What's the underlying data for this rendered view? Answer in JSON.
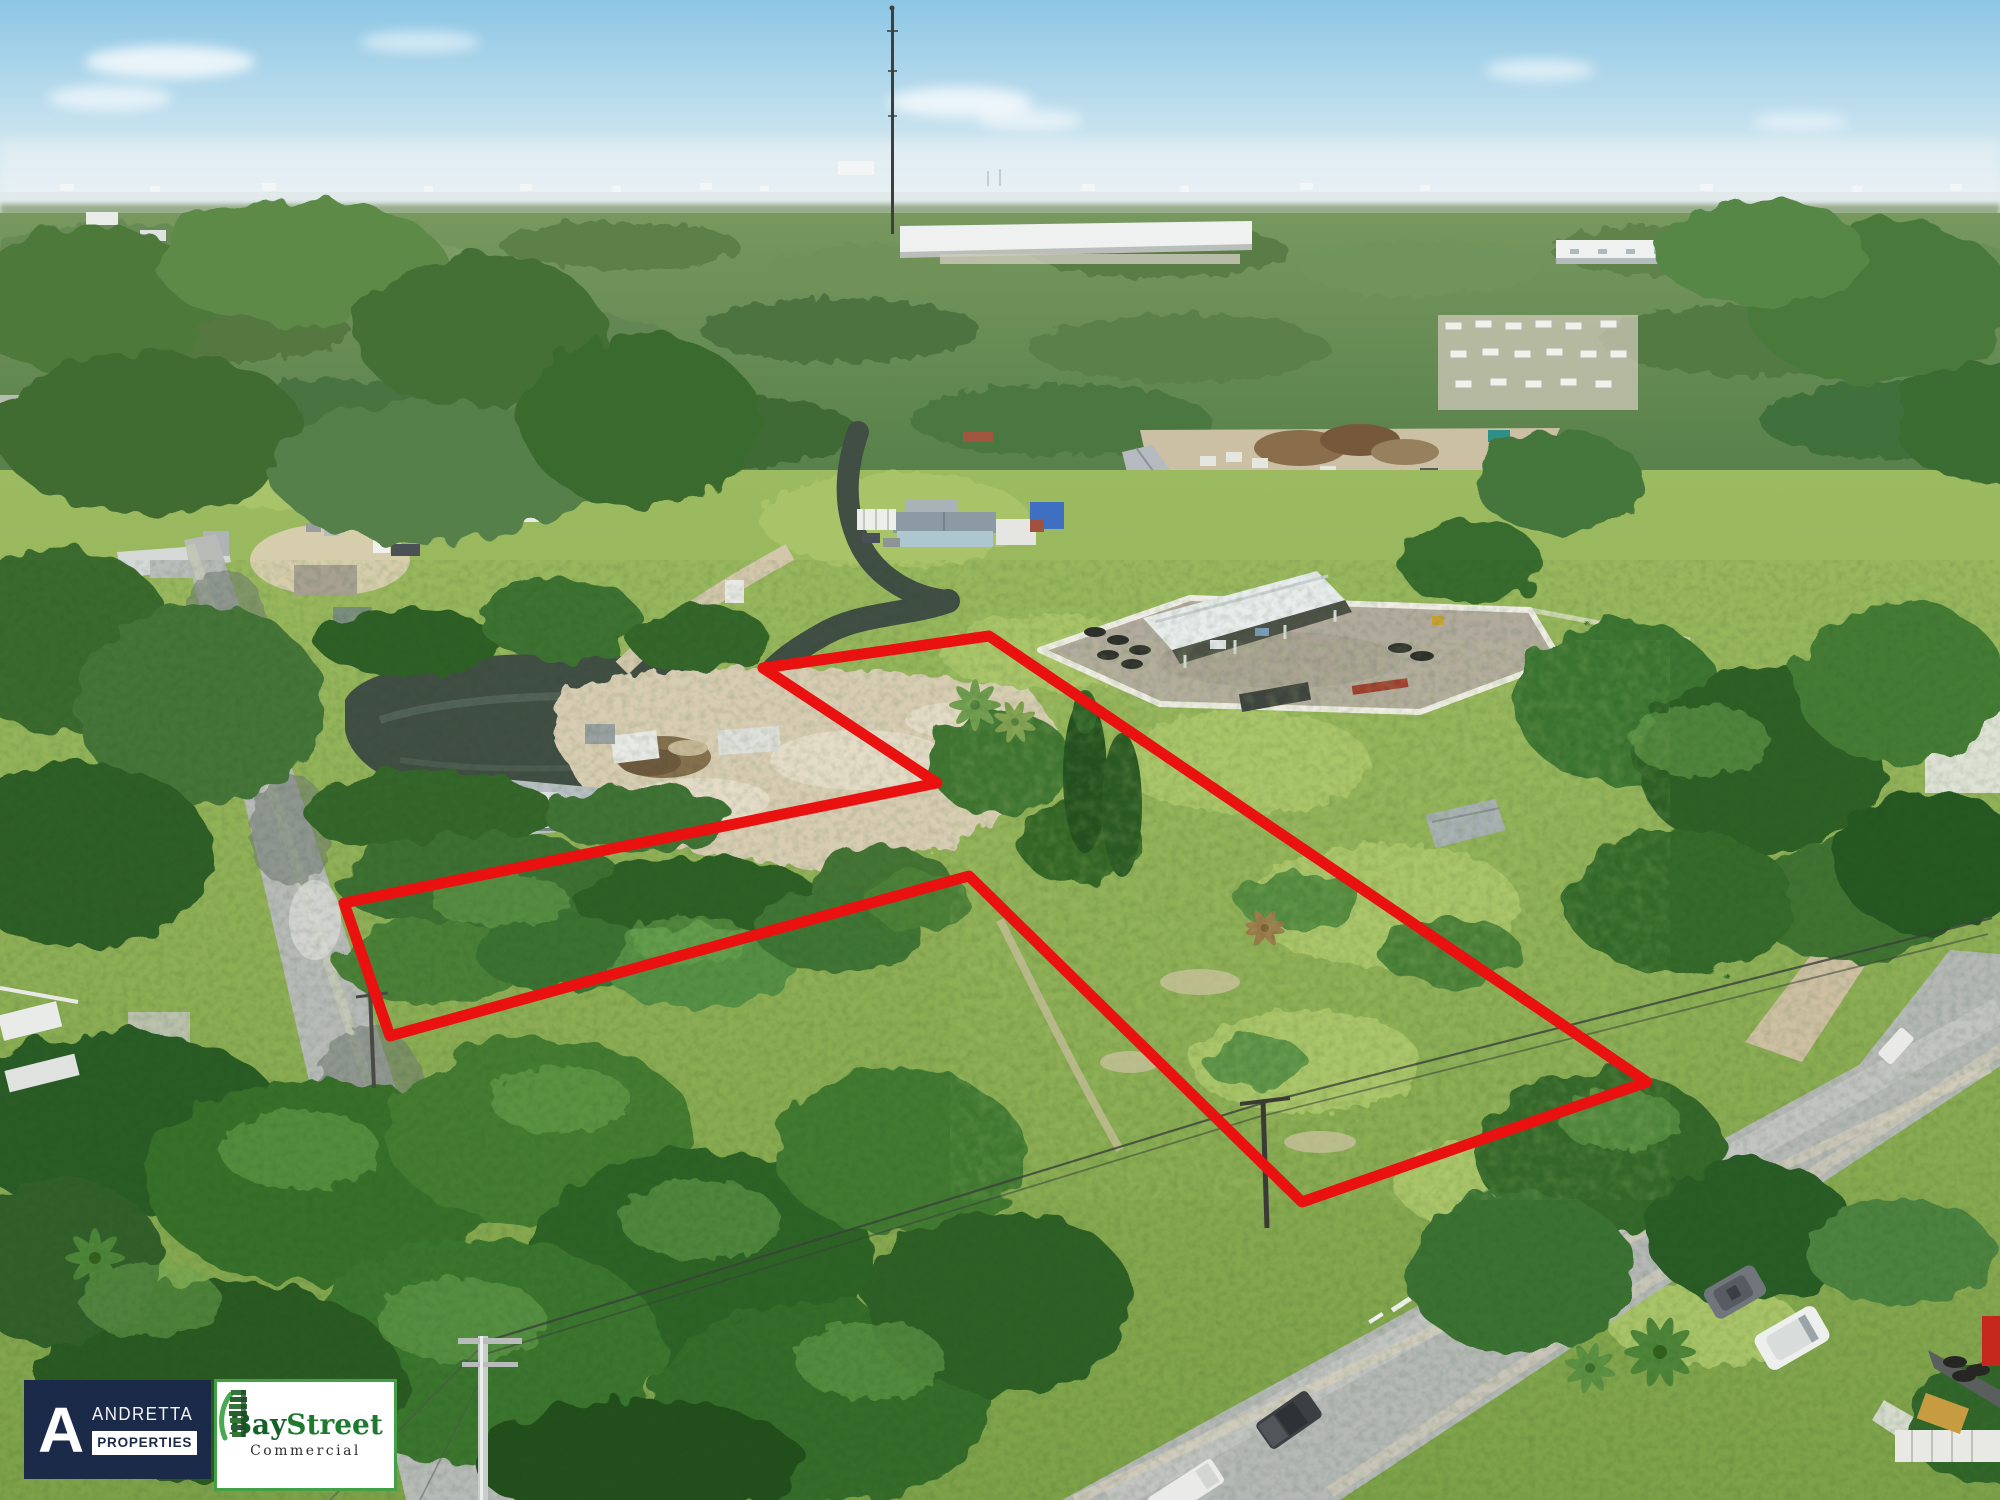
{
  "image": {
    "kind": "aerial-drone-real-estate-photo",
    "subject": "Vacant wooded land parcels outlined in red beside residential streets and an industrial yard"
  },
  "boundary": {
    "color": "#ea1111",
    "stroke_width": 11,
    "points": "989,636 1647,1082 1302,1202 969,876 390,1036 344,903 937,783 763,668"
  },
  "badges": {
    "andretta": {
      "initial": "A",
      "name": "ANDRETTA",
      "sub": "PROPERTIES",
      "bg_color": "#1b2a49",
      "text_color": "#ffffff"
    },
    "baystreet": {
      "brand_a": "Bay",
      "brand_b": "Street",
      "sub": "Commercial",
      "border_color": "#43a047",
      "green_dark": "#156028",
      "green": "#1e7a30",
      "sub_color": "#2f2f2f"
    }
  },
  "scene_colors": {
    "sky": "#8cc6e4",
    "haze": "#edf3f4",
    "background_trees": "#6a8c56",
    "canopy": "#3b712e",
    "meadow": "#8db054",
    "road": "#b7bab7",
    "water": "#414e44",
    "dirt_clearing": "#d8cdb3",
    "warehouse_roof": "#eef1f0",
    "yard_concrete": "#b2ab9d",
    "perimeter_wall": "#efede5"
  }
}
